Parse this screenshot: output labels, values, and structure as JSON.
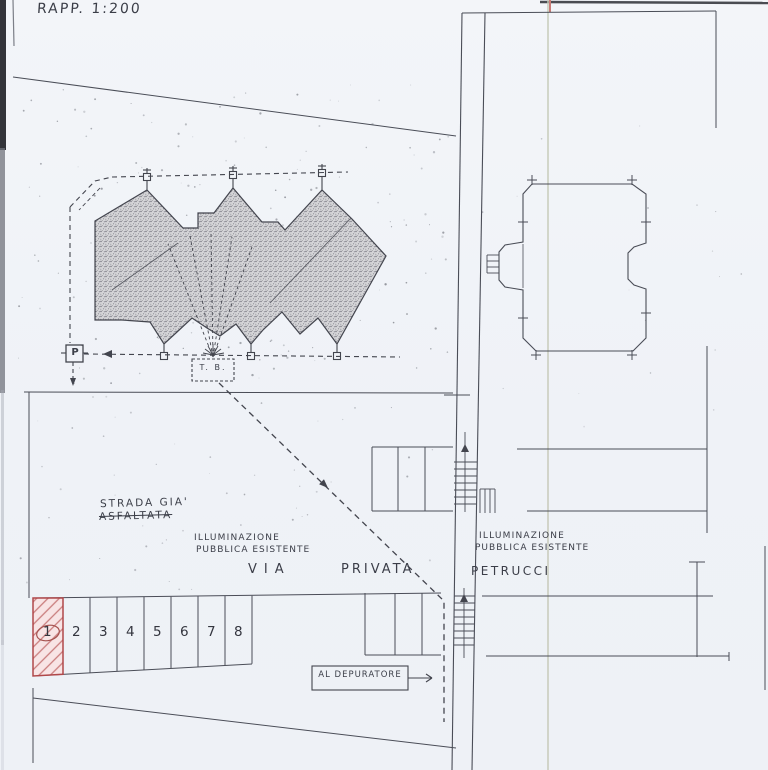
{
  "sheet": {
    "scale_label": "RAPP. 1:200",
    "annotations": {
      "road_status_line1": "STRADA GIA'",
      "road_status_line2": "ASFALTATA",
      "lighting_left_line1": "ILLUMINAZIONE",
      "lighting_left_line2": "PUBBLICA ESISTENTE",
      "lighting_right_line1": "ILLUMINAZIONE",
      "lighting_right_line2": "PUBBLICA ESISTENTE",
      "street_name_word1": "VIA",
      "street_name_word2": "PRIVATA",
      "street_name_word3": "PETRUCCI",
      "depurator_label": "AL DEPURATORE",
      "transformer_box_label": "T. B.",
      "lamp_post_label": "P"
    },
    "parking": {
      "space_numbers": [
        "1",
        "2",
        "3",
        "4",
        "5",
        "6",
        "7",
        "8"
      ],
      "highlighted_space": "1"
    },
    "colors": {
      "ink": "#3b3e48",
      "paper": "#f1f3f8",
      "highlight_red": "#b0484a",
      "highlight_fill": "#f8e4e5",
      "fold_line": "#c6cab8"
    }
  }
}
